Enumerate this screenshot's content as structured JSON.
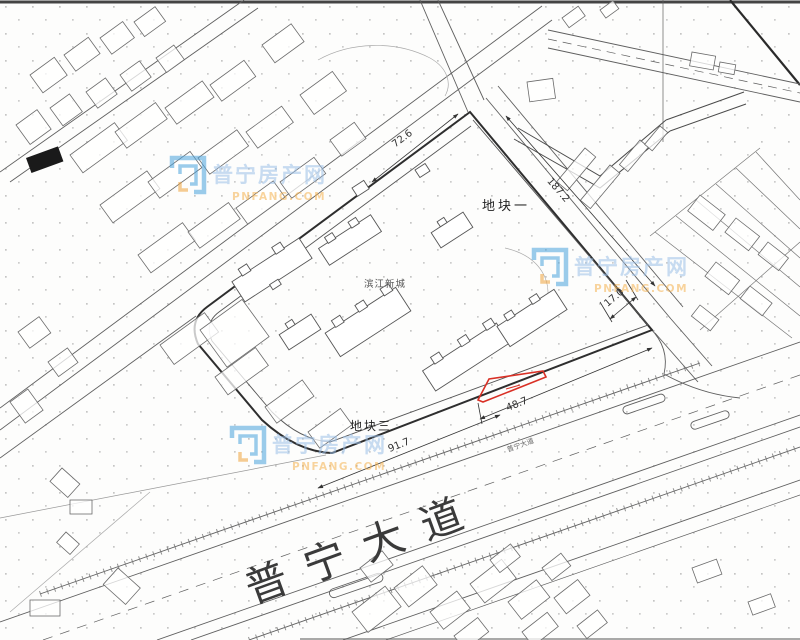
{
  "map": {
    "labels": {
      "plot1": "地块一",
      "plot3": "地块三",
      "complex": "滨江新城",
      "avenue": "普宁大道",
      "avenue_small": "普宁大道"
    },
    "dimensions": {
      "top_edge": "72.6",
      "northeast_road": "187.2",
      "east_road_width": "17.0",
      "south_right": "48.7",
      "south_left": "91.7"
    },
    "watermark": {
      "title": "普宁房产网",
      "domain": "PNFANG.COM"
    },
    "colors": {
      "highlight_red": "#d93025",
      "watermark_blue": "#9cc0e8",
      "watermark_orange": "#f5b14e",
      "line": "#4a4a4a"
    }
  }
}
